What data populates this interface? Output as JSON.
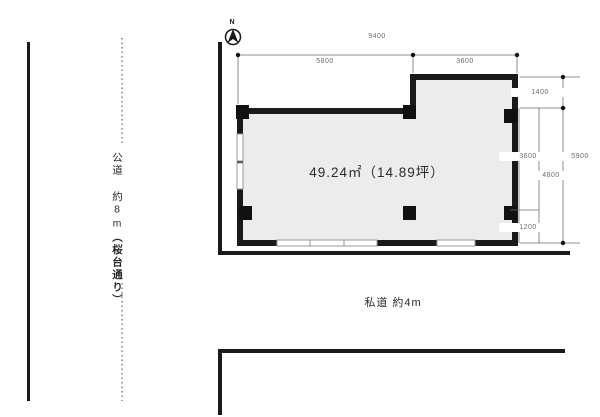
{
  "meta": {
    "background": "#ffffff",
    "line_color": "#1a1a1a",
    "dim_line_color": "#6e6e6e",
    "floor_fill": "#ececec",
    "window_mark_color": "#999999"
  },
  "compass": {
    "label": "N"
  },
  "dimensions": {
    "top_total": "9400",
    "top_left_segment": "5800",
    "top_right_segment": "3600",
    "right_upper": "1400",
    "right_inner_upper": "3600",
    "right_middle": "4800",
    "right_inner_lower": "1200",
    "right_total": "5900"
  },
  "labels": {
    "area": "49.24㎡（14.89坪）",
    "public_road": "公道 約8m",
    "public_road_name": "（桜台通り）",
    "private_road": "私道 約4m"
  }
}
